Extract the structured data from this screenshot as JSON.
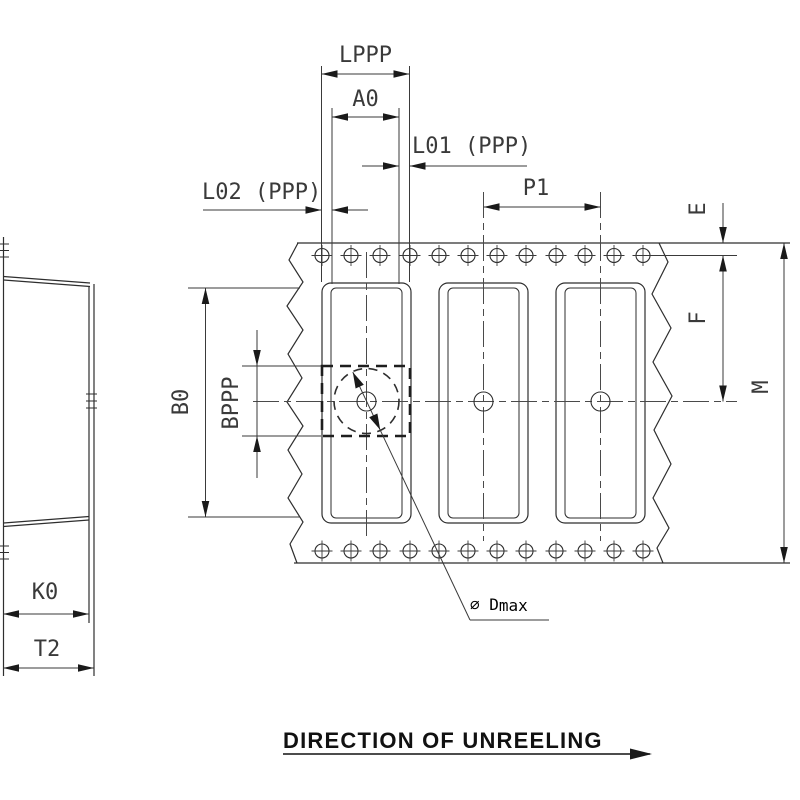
{
  "drawing": {
    "labels": {
      "lppp": "LPPP",
      "a0": "A0",
      "l01": "L01 (PPP)",
      "l02": "L02 (PPP)",
      "p1": "P1",
      "e": "E",
      "f": "F",
      "m": "M",
      "b0": "B0",
      "bppp": "BPPP",
      "k0": "K0",
      "t2": "T2",
      "dmax_prefix": "∅ D",
      "dmax_sub": "max"
    },
    "footer": {
      "direction_label": "DIRECTION OF UNREELING"
    },
    "colors": {
      "line": "#2e2e2e",
      "arrow": "#1a1a1a",
      "background": "#ffffff"
    }
  }
}
